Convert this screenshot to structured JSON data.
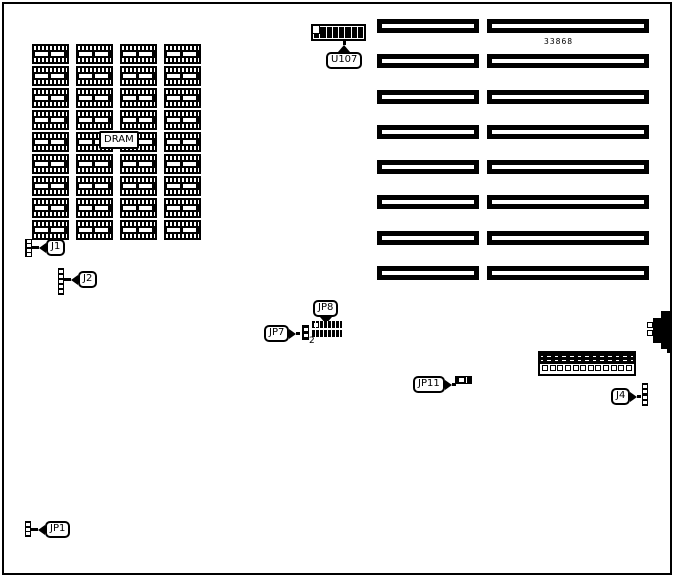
{
  "board": {
    "part_number": "33868",
    "jp8_pin_label": "2"
  },
  "labels": {
    "dram": "DRAM",
    "u107": "U107",
    "j1": "J1",
    "j2": "J2",
    "j4": "J4",
    "jp1": "JP1",
    "jp7": "JP7",
    "jp8": "JP8",
    "jp11": "JP11"
  },
  "colors": {
    "ink": "#000000",
    "paper": "#ffffff"
  },
  "dram_grid": {
    "rows": 9,
    "cols": 4,
    "chip_count": 36
  },
  "expansion_slots": {
    "rows": 8,
    "columns": 2
  },
  "u107_chip": {
    "segments": 8
  },
  "jp8_header": {
    "pin_columns": 8,
    "pin_rows": 2
  },
  "long_connector": {
    "positions": 12
  },
  "pin_strips": {
    "j1": 4,
    "j2": 5,
    "j4": 4,
    "jp1": 3,
    "jp7": 2
  }
}
